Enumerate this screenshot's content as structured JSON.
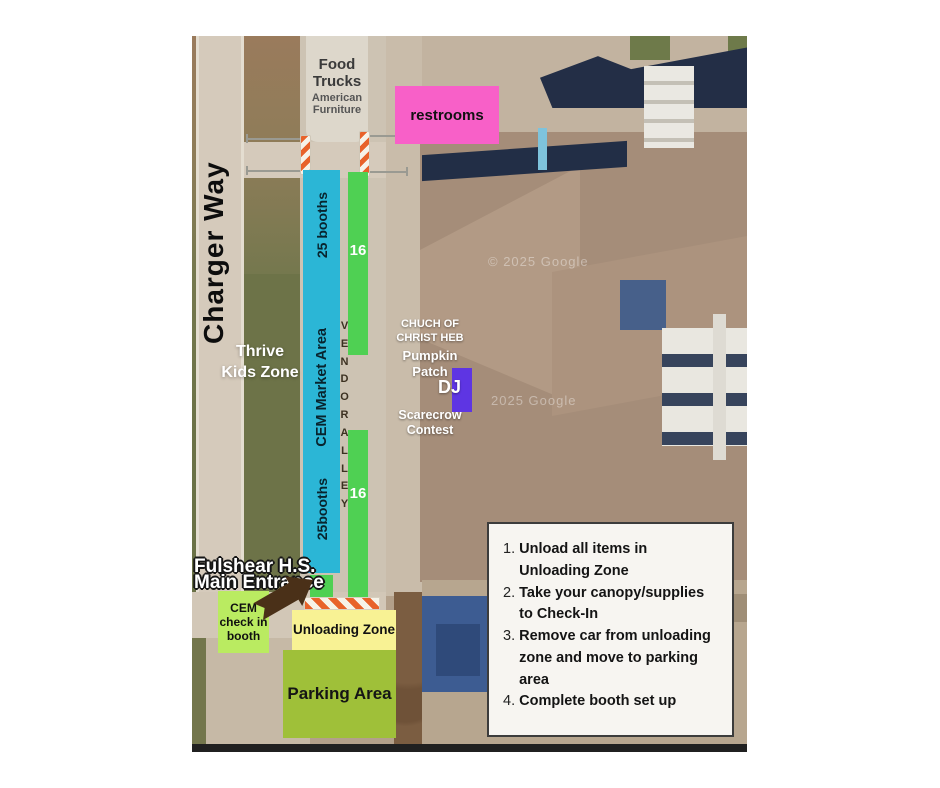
{
  "map": {
    "street_label": "Charger Way",
    "food_trucks_title": "Food Trucks",
    "food_trucks_subtitle": "American Furniture",
    "restrooms_label": "restrooms",
    "market_top_label": "25 booths",
    "market_mid_label": "CEM Market Area",
    "market_bottom_label": "25booths",
    "vendor_alley_label": "VENDOR ALLEY",
    "booth_count_top": "16",
    "booth_count_bottom": "16",
    "thrive_zone_label": "Thrive Kids Zone",
    "church_label": "CHUCH OF CHRIST HEB",
    "pumpkin_label": "Pumpkin Patch",
    "dj_label": "DJ",
    "scarecrow_label": "Scarecrow Contest",
    "entrance_line1": "Fulshear H.S.",
    "entrance_line2": "Main Entrance",
    "check_in_label": "CEM check in booth",
    "unloading_label": "Unloading Zone",
    "parking_label": "Parking Area",
    "watermark_top": "© 2025 Google",
    "watermark_mid": "2025 Google"
  },
  "instructions": {
    "items": [
      "Unload all items in Unloading Zone",
      "Take your canopy/supplies to Check-In",
      "Remove car from unloading zone and move to parking area",
      "Complete booth set up"
    ]
  },
  "colors": {
    "market_bar": "#2bb6d6",
    "vendor_row_green": "#4fd053",
    "restrooms_pink": "#f860c8",
    "dj_purple": "#5e35e3",
    "check_in_green": "#baeb61",
    "unloading_yellow": "#f8f294",
    "parking_green": "#9fc039",
    "arrow_brown": "#4a3018",
    "barrier_orange": "#e8622a"
  }
}
